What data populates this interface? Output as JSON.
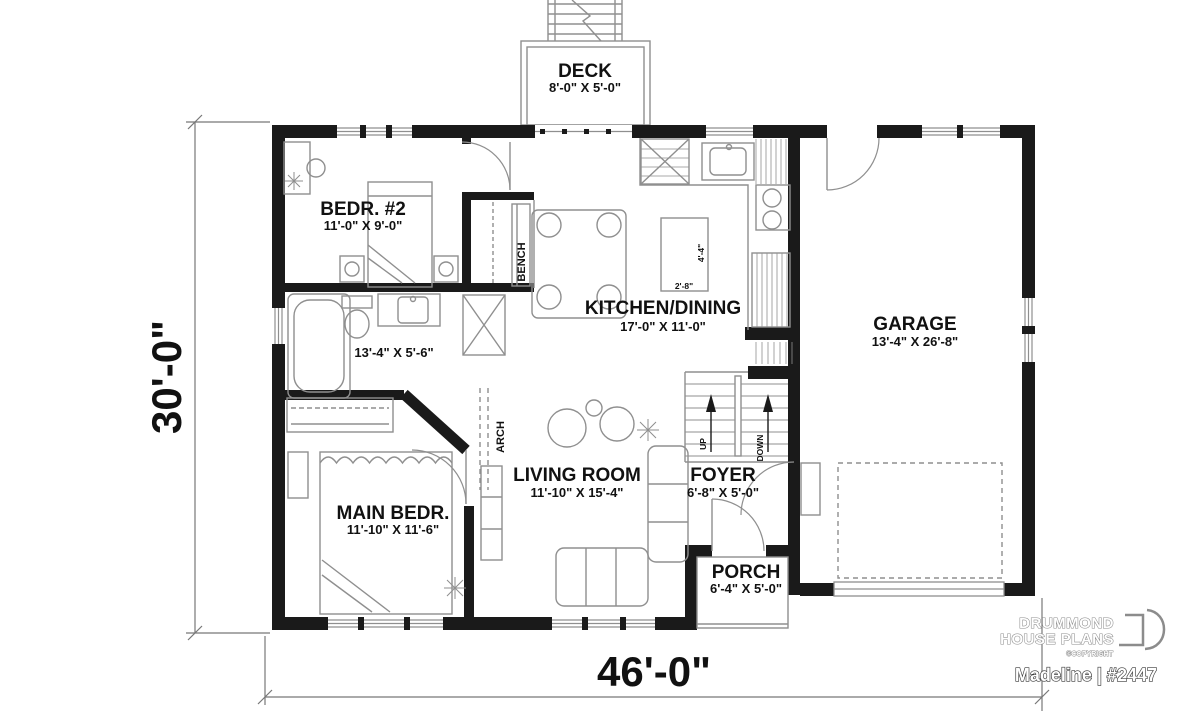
{
  "plan": {
    "brand": {
      "name_line1": "DRUMMOND",
      "name_line2": "HOUSE PLANS",
      "copyright": "©COPYRIGHT",
      "plan_name": "Madeline | #2447"
    },
    "dimensions": {
      "total_width": "46'-0\"",
      "total_depth": "30'-0\""
    },
    "rooms": [
      {
        "id": "deck",
        "name": "DECK",
        "size": "8'-0\" X 5'-0\""
      },
      {
        "id": "bedroom2",
        "name": "BEDR. #2",
        "size": "11'-0\" X 9'-0\""
      },
      {
        "id": "bathroom",
        "name": "",
        "size": "13'-4\" X 5'-6\""
      },
      {
        "id": "kitchen",
        "name": "KITCHEN/DINING",
        "size": "17'-0\" X 11'-0\""
      },
      {
        "id": "garage",
        "name": "GARAGE",
        "size": "13'-4\" X 26'-8\""
      },
      {
        "id": "living",
        "name": "LIVING ROOM",
        "size": "11'-10\" X 15'-4\""
      },
      {
        "id": "foyer",
        "name": "FOYER",
        "size": "6'-8\" X 5'-0\""
      },
      {
        "id": "mainbed",
        "name": "MAIN BEDR.",
        "size": "11'-10\" X 11'-6\""
      },
      {
        "id": "porch",
        "name": "PORCH",
        "size": "6'-4\" X 5'-0\""
      }
    ],
    "annotations": {
      "bench": "BENCH",
      "arch": "ARCH",
      "up": "UP",
      "down": "DOWN",
      "island_depth": "4'-4\"",
      "island_width": "2'-8\""
    },
    "colors": {
      "wall": "#1a1a1a",
      "fixture": "#8f8f8f",
      "text": "#111111"
    }
  }
}
